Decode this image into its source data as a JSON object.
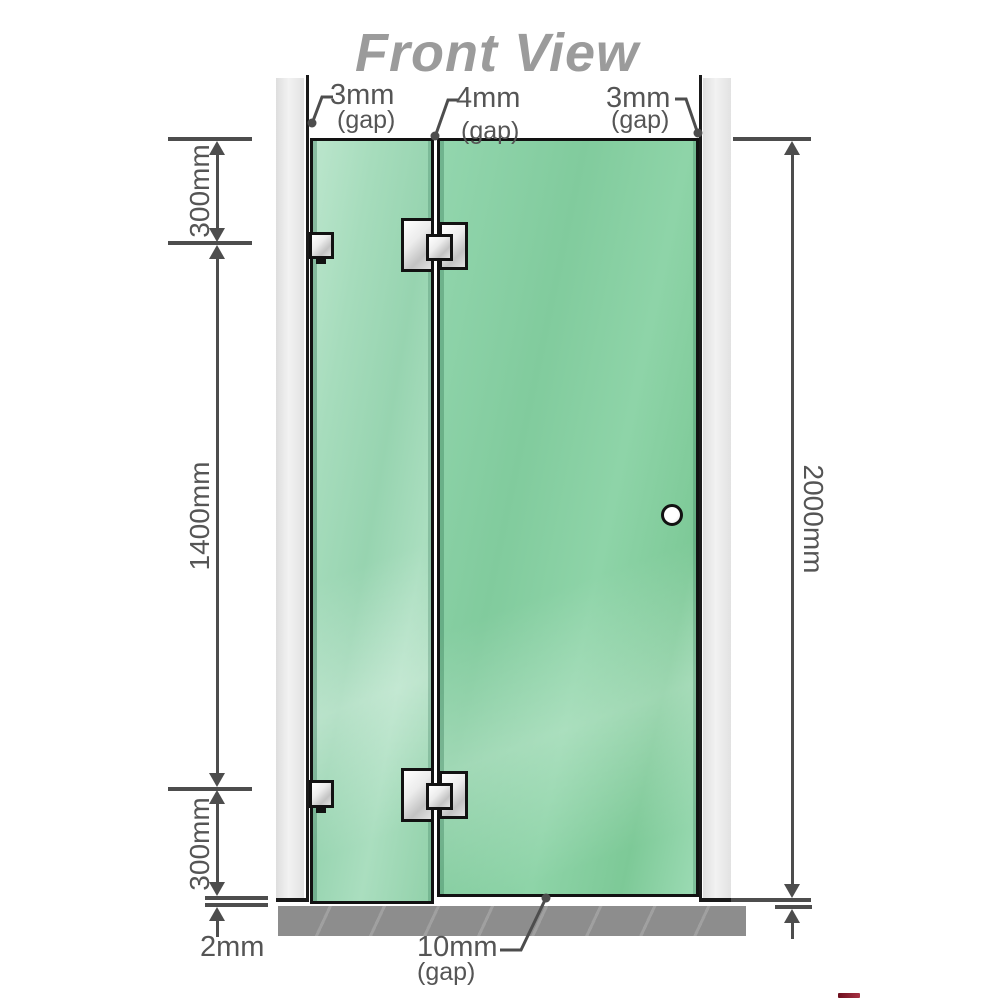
{
  "title": "Front View",
  "diagram": {
    "gaps": {
      "left": {
        "value": "3mm",
        "label": "(gap)"
      },
      "middle": {
        "value": "4mm",
        "label": "(gap)"
      },
      "right": {
        "value": "3mm",
        "label": "(gap)"
      },
      "bottom": {
        "value": "10mm",
        "label": "(gap)"
      }
    },
    "dimensions": {
      "left_top_segment": "300mm",
      "left_middle_segment": "1400mm",
      "left_bottom_segment": "300mm",
      "right_total_height": "2000mm",
      "floor_clearance": "2mm"
    },
    "colors": {
      "glass_door": "#81cb9d",
      "glass_fixed_panel": "#a6dcbc",
      "wall_channel": "#e9e9e9",
      "floor": "#8d8d8d",
      "outline": "#121212",
      "dimension_lines": "#4d4d4d",
      "label_text": "#555555",
      "title_text": "#9b9b9b",
      "metal_fitting": "#dcdcdc",
      "artifact_red": "#8b1a2a"
    }
  }
}
